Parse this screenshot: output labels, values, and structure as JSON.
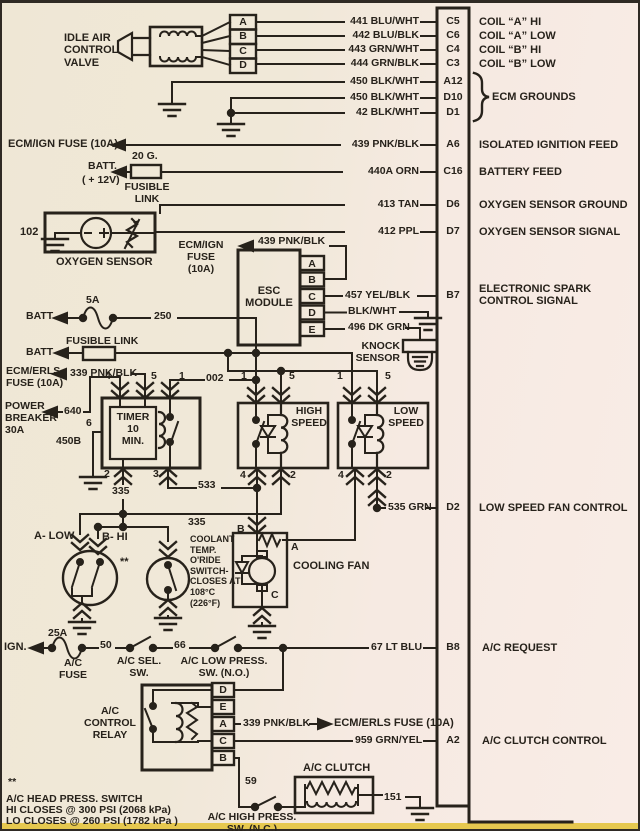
{
  "colors": {
    "paper": "#f0e8d8",
    "paper_pink": "#f9ece6",
    "ink": "#27221b",
    "frame": "#2f2a24",
    "bottom_strip": "#e6c84f"
  },
  "iac": {
    "title": "IDLE AIR\nCONTROL\nVALVE",
    "pins": [
      "A",
      "B",
      "C",
      "D"
    ]
  },
  "rows": [
    {
      "wire": "441 BLU/WHT",
      "pin": "C5",
      "desc": "COIL “A” HI"
    },
    {
      "wire": "442 BLU/BLK",
      "pin": "C6",
      "desc": "COIL “A” LOW"
    },
    {
      "wire": "443 GRN/WHT",
      "pin": "C4",
      "desc": "COIL “B” HI"
    },
    {
      "wire": "444 GRN/BLK",
      "pin": "C3",
      "desc": "COIL “B” LOW"
    },
    {
      "wire": "450 BLK/WHT",
      "pin": "A12",
      "desc": ""
    },
    {
      "wire": "450 BLK/WHT",
      "pin": "D10",
      "desc": "ECM GROUNDS"
    },
    {
      "wire": "42 BLK/WHT",
      "pin": "D1",
      "desc": ""
    },
    {
      "wire": "439 PNK/BLK",
      "pin": "A6",
      "desc": "ISOLATED IGNITION FEED"
    },
    {
      "wire": "440A ORN",
      "pin": "C16",
      "desc": "BATTERY FEED"
    },
    {
      "wire": "413 TAN",
      "pin": "D6",
      "desc": "OXYGEN SENSOR GROUND"
    },
    {
      "wire": "412 PPL",
      "pin": "D7",
      "desc": "OXYGEN SENSOR SIGNAL"
    },
    {
      "wire": "457 YEL/BLK",
      "pin": "B7",
      "desc": "ELECTRONIC SPARK\nCONTROL SIGNAL"
    },
    {
      "wire": "535 GRN",
      "pin": "D2",
      "desc": "LOW SPEED FAN CONTROL"
    },
    {
      "wire": "67 LT BLU",
      "pin": "B8",
      "desc": "A/C REQUEST"
    },
    {
      "wire": "959 GRN/YEL",
      "pin": "A2",
      "desc": "A/C CLUTCH CONTROL"
    }
  ],
  "misc": {
    "ecm_ign_fuse": "ECM/IGN FUSE (10A)",
    "batt": "BATT.",
    "p12v": "( + 12V)",
    "g20": "20 G.",
    "fusible_2l": "FUSIBLE\nLINK",
    "o2_id": "102",
    "o2_label": "OXYGEN SENSOR",
    "esc_fuse": "ECM/IGN FUSE\n(10A)",
    "w439": "439 PNK/BLK",
    "esc_title": "ESC\nMODULE",
    "esc_pins": [
      "A",
      "B",
      "C",
      "D",
      "E"
    ],
    "blkwht": "BLK/WHT",
    "w496": "496 DK GRN",
    "knock": "KNOCK\nSENSOR",
    "batt2": "BATT",
    "f5a": "5A",
    "w250": "250",
    "fusible_1l": "FUSIBLE LINK",
    "batt3": "BATT",
    "ecm_erls": "ECM/ERLS\nFUSE (10A)",
    "w339": "339 PNK/BLK",
    "power_breaker": "POWER\nBREAKER\n30A",
    "w640": "640",
    "p6": "6",
    "w450b": "450B",
    "timer": "TIMER\n10\nMIN.",
    "timer_pins": {
      "t4": "4",
      "t5": "5",
      "t1": "1",
      "b2": "2",
      "b3": "3"
    },
    "w002": "002",
    "w335a": "335",
    "w335b": "335",
    "w533": "533",
    "high": "HIGH\nSPEED",
    "low": "LOW\nSPEED",
    "hs_pins": {
      "t1": "1",
      "t5": "5",
      "b4": "4",
      "b2": "2"
    },
    "ls_pins": {
      "t1": "1",
      "t5": "5",
      "b4": "4",
      "b2": "2"
    },
    "a_low": "A- LOW",
    "b_hi": "B- HI",
    "stars": "**",
    "coolant": "COOLANT\nTEMP.\nO'RIDE\nSWITCH-\nCLOSES AT\n108°C\n(226°F)",
    "fan_b": "B",
    "fan_a": "A",
    "fan_c": "C",
    "cooling_fan": "COOLING FAN",
    "ign": "IGN.",
    "f25a": "25A",
    "ac_fuse": "A/C\nFUSE",
    "w50": "50",
    "sel_sw": "A/C SEL.\nSW.",
    "w66": "66",
    "low_press": "A/C LOW PRESS.\nSW. (N.O.)",
    "ac_relay": "A/C\nCONTROL\nRELAY",
    "relay_pins": [
      "D",
      "E",
      "A",
      "C",
      "B"
    ],
    "w339b": "339 PNK/BLK",
    "to_erls": "ECM/ERLS FUSE (10A)",
    "w59": "59",
    "ac_clutch": "A/C CLUTCH",
    "w151": "151",
    "hi_press": "A/C HIGH PRESS.\nSW. (N.C.)",
    "note_stars": "**",
    "note1": "A/C HEAD PRESS. SWITCH",
    "note2": "HI CLOSES @ 300 PSI (2068 kPa)",
    "note3": "LO CLOSES @ 260 PSI (1782 kPa )"
  }
}
